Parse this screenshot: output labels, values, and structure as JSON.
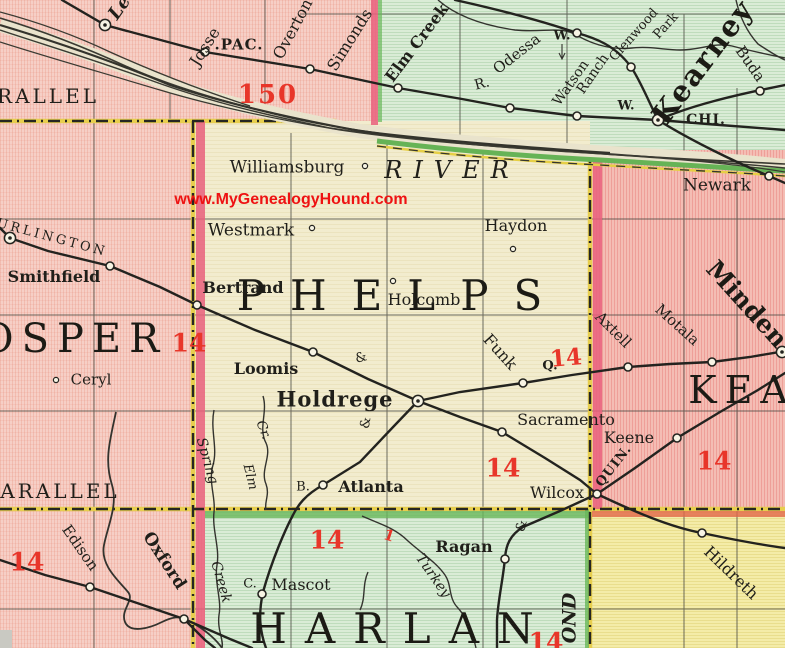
{
  "labels": {
    "lexington": "Le",
    "josselyn": "Josse",
    "pac": ".PAC.",
    "overton": "Overton",
    "simonds": "Simonds",
    "parallel_top": "RALLEL",
    "n150": "150",
    "elm_creek": "Elm Creek",
    "r_abbr": "R.",
    "odessa": "Odessa",
    "w_abbr": "W.",
    "watson": "Watson",
    "ranch": "Ranch",
    "glenwood": "Glenwood",
    "park": "Park",
    "kearney_city": "Kearney",
    "buda": "Buda",
    "chi": "CHI.",
    "newark": "Newark",
    "williamsburg": "Williamsburg",
    "river": "RIVER",
    "watermark": "www.MyGenealogyHound.com",
    "westmark": "Westmark",
    "haydon": "Haydon",
    "phelps": "PHELPS",
    "burlington": "URLINGTON",
    "smithfield": "Smithfield",
    "gosper": "OSPER",
    "ceryl": "Ceryl",
    "bertrand": "Bertrand",
    "holcomb": "Holcomb",
    "loomis": "Loomis",
    "holdrege": "Holdrege",
    "funk": "Funk",
    "q_abbr": "Q.",
    "minden": "Minden",
    "motala": "Motala",
    "axtell": "Axtell",
    "kearney_county": "KEA",
    "sacramento": "Sacramento",
    "keene": "Keene",
    "quin": "QUIN.",
    "wilcox": "Wilcox",
    "spring": "Spring",
    "cr_abbr": "Cr.",
    "elm": "Elm",
    "b_abbr": "B.",
    "atlanta": "Atlanta",
    "parallel_bottom": "ARALLEL",
    "edison": "Edison",
    "oxford": "Oxford",
    "creek": "Creek",
    "ragan": "Ragan",
    "turkey": "Turkey",
    "c_abbr": "C.",
    "mascot": "Mascot",
    "harlan": "HARLAN",
    "ond": "OND",
    "hildreth": "Hildreth",
    "ampersand": "&",
    "n14": "14",
    "red_mark": "1"
  },
  "colors": {
    "red_overprint": "#e8362a",
    "watermark_red": "#ee1212",
    "border_magenta": "#e9607c",
    "border_yellow": "#e7ce4e",
    "border_green_band": "#69b85a",
    "phelps_fill": "#f2ecce",
    "pink_fill": "#f6cfc6",
    "kearney_fill": "#f4bdb4",
    "green_fill": "#daecd6",
    "yellow_fill": "#f4eca8",
    "line_ink": "#23231f"
  }
}
